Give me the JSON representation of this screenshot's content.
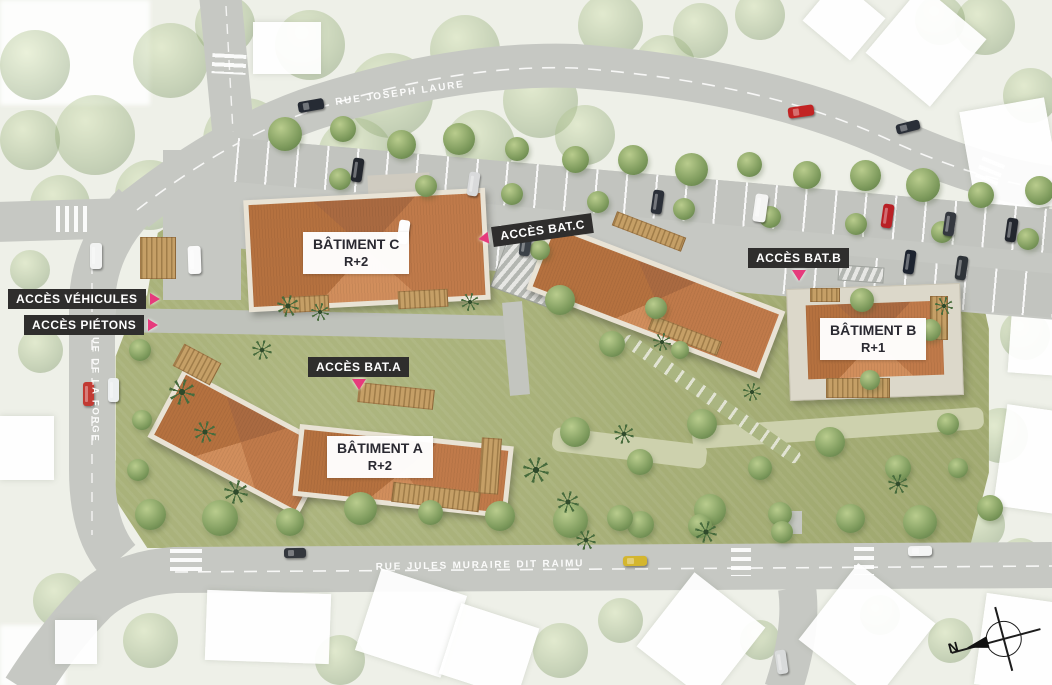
{
  "plan": {
    "streets": {
      "joseph_laure": "RUE JOSEPH LAURE",
      "de_la_forge": "RUE DE LA FORGE",
      "jules_muraire": "RUE JULES MURAIRE DIT RAIMU"
    },
    "buildings": {
      "a": {
        "name": "BÂTIMENT A",
        "level": "R+2"
      },
      "b": {
        "name": "BÂTIMENT B",
        "level": "R+1"
      },
      "c": {
        "name": "BÂTIMENT C",
        "level": "R+2"
      }
    },
    "access": {
      "vehicles": "ACCÈS VÉHICULES",
      "pedestrians": "ACCÈS PIÉTONS",
      "bat_a": "ACCÈS BAT.A",
      "bat_b": "ACCÈS BAT.B",
      "bat_c": "ACCÈS BAT.C"
    },
    "compass": {
      "north": "N"
    },
    "colors": {
      "accent_pink": "#e63a7c",
      "roof_terracotta": "#c07a4a",
      "lawn_green": "#a7b075",
      "road_gray": "#c6c8c3",
      "label_dark": "#2f2e2d"
    }
  }
}
